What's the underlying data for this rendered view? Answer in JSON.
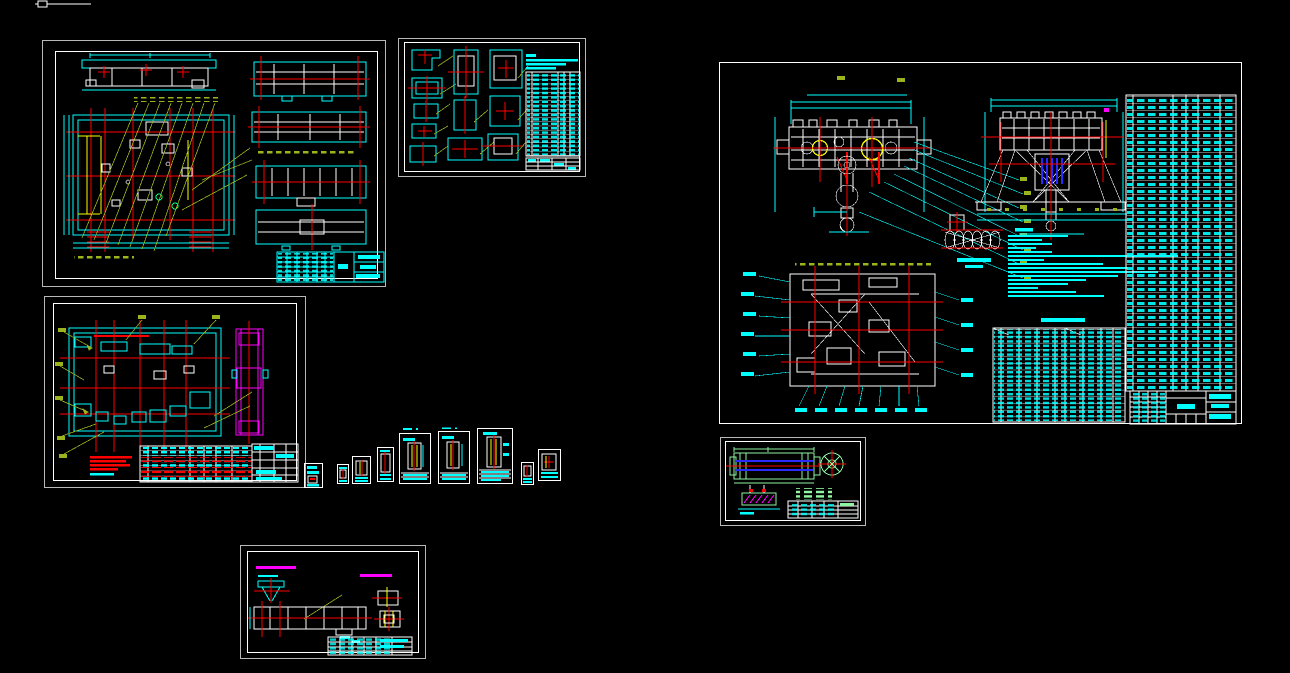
{
  "app": {
    "type": "cad-model-space-canvas",
    "background_color": "#000000",
    "legible_text": "none — all drawing annotations, dimensions, tables and title blocks are below legibility threshold at capture resolution"
  },
  "palette": {
    "background": "#000000",
    "sheet_border": "#ffffff",
    "sheet_border_dim": "#b9b9b9",
    "annotation_cyan": "#00ffff",
    "centerline_red": "#ff0000",
    "highlight_yellow": "#ffff00",
    "leader_olive": "#9ab41e",
    "detail_magenta": "#ff00ff",
    "drum_blue": "#2a2aff",
    "drawing_green": "#8ef5a0"
  },
  "viewport_marker": {
    "description": "small white box with horizontal line fragment at canvas top-left edge"
  },
  "sheets": [
    {
      "id": "sheet-a",
      "description": "large frame assembly sheet: beam elevation top-left, big plan view with red centerline grid and yellow highlights, four section strips at right, olive leader fan, title block lower-right"
    },
    {
      "id": "sheet-b",
      "description": "parts detail sheet: ~11 small cyan part views with red centers, cyan notes and tall parts-list table on right, small title block"
    },
    {
      "id": "sheet-c",
      "description": "crane trolley general assembly sheet: front view with two yellow circles and hook, end view with blue rope drum, rope reeving diagram, cyan technical notes, plan view with callouts, technical-performance table, full-height BOM column, title block"
    },
    {
      "id": "sheet-d",
      "description": "frame plan sheet: cyan plan view with heavy red grid, magenta side elevation, olive leader arrows, red note lines, parts table with red and cyan rows"
    },
    {
      "id": "sheet-d2",
      "description": "tiny detail slip at right edge of sheet-d"
    },
    {
      "id": "sheet-e1",
      "description": "small part sheet"
    },
    {
      "id": "sheet-e2",
      "description": "small part sheet"
    },
    {
      "id": "sheet-e3",
      "description": "small part sheet"
    },
    {
      "id": "sheet-e4",
      "description": "small part sheet with cyan label above"
    },
    {
      "id": "sheet-e5",
      "description": "small part sheet with cyan label above"
    },
    {
      "id": "sheet-e6",
      "description": "small part sheet (largest of row)"
    },
    {
      "id": "sheet-e7",
      "description": "small part sheet"
    },
    {
      "id": "sheet-e8",
      "description": "small part sheet"
    },
    {
      "id": "sheet-f",
      "description": "end-beam sheet: magenta captions, cyan bracket view, long white beam with red centerlines, yellow detail views, green leader, title block"
    },
    {
      "id": "sheet-g",
      "description": "rope drum sheet in green linework: drum side view with blue lines and red centerline, end-view circle, hatched magenta bracket detail, green notes, title block"
    }
  ]
}
